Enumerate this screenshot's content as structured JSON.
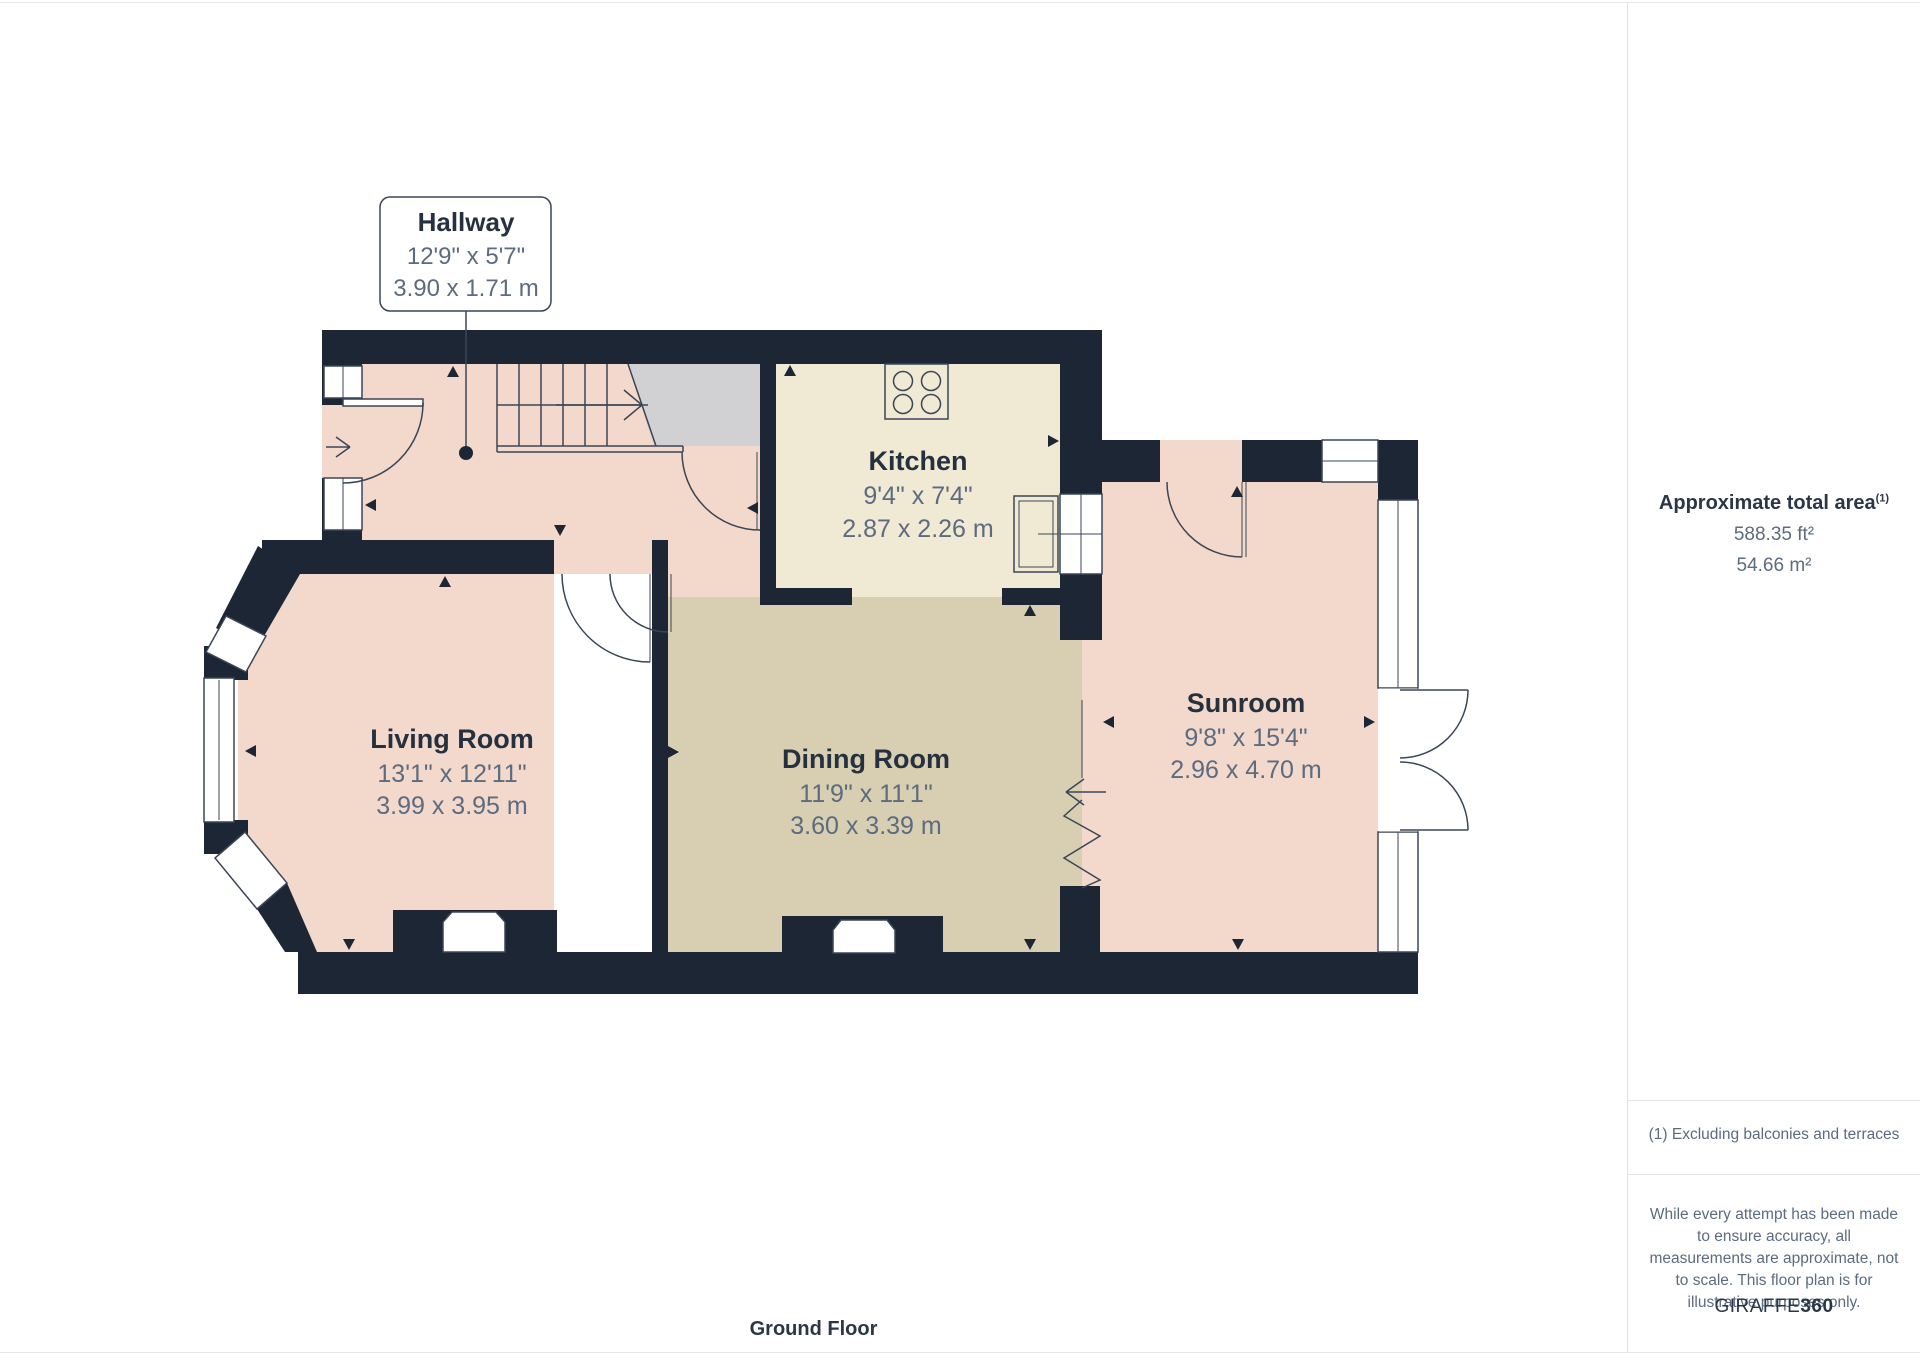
{
  "plan": {
    "floor_label": "Ground Floor",
    "callout": {
      "name": "Hallway",
      "imperial": "12'9\" x 5'7\"",
      "metric": "3.90 x 1.71 m"
    },
    "rooms": [
      {
        "name": "Kitchen",
        "imperial": "9'4\" x 7'4\"",
        "metric": "2.87 x 2.26 m"
      },
      {
        "name": "Living Room",
        "imperial": "13'1\" x 12'11\"",
        "metric": "3.99 x 3.95 m"
      },
      {
        "name": "Dining Room",
        "imperial": "11'9\" x 11'1\"",
        "metric": "3.60 x 3.39 m"
      },
      {
        "name": "Sunroom",
        "imperial": "9'8\" x 15'4\"",
        "metric": "2.96 x 4.70 m"
      }
    ]
  },
  "sidebar": {
    "area_title": "Approximate total area",
    "area_superscript": "(1)",
    "area_ft": "588.35 ft²",
    "area_m": "54.66 m²",
    "footnote": "(1) Excluding balconies and terraces",
    "disclaimer": "While every attempt has been made to ensure accuracy, all measurements are approximate, not to scale. This floor plan is for illustrative purposes only.",
    "brand_regular": "GIRAFFE",
    "brand_bold": "360"
  },
  "icons": {
    "stairs": "stairs-up-icon",
    "hob": "cooktop-4-burner-icon",
    "sink": "kitchen-sink-icon",
    "entrance_arrow": "entrance-arrow-icon",
    "radiator": "zigzag-opening-icon"
  },
  "colors": {
    "wall": "#1d2634",
    "room_pink": "#f3d9cc",
    "kitchen_cream": "#f0e9d4",
    "dining_khaki": "#d8cfb2",
    "stairs_gray": "#d1d1d3",
    "line": "#3a4656",
    "text_dark": "#26313f",
    "text_dim": "#5b6b80",
    "divider": "#e4e4e4"
  }
}
